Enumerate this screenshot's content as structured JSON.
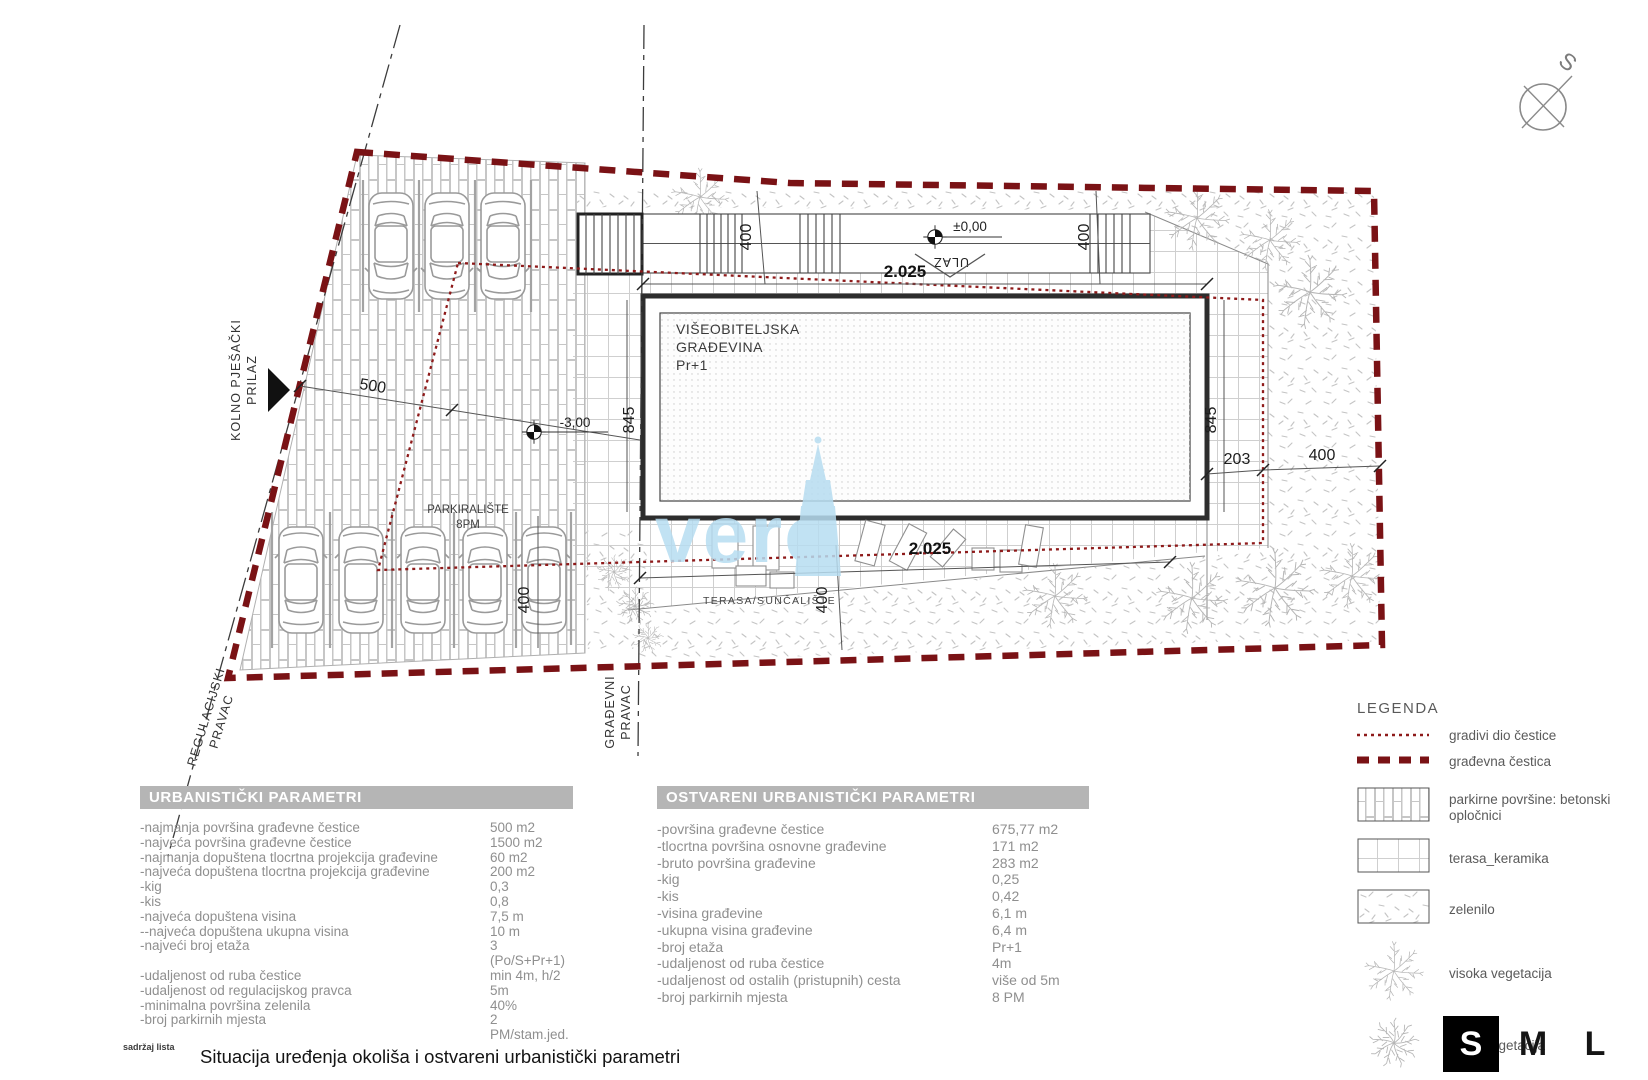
{
  "compass": {
    "north_label": "S"
  },
  "watermark": {
    "text": "vero"
  },
  "plan": {
    "labels": {
      "access_road_line1": "KOLNO PJEŠAČKI",
      "access_road_line2": "PRILAZ",
      "regulation_line1": "REGULACIJSKI",
      "regulation_line2": "PRAVAC",
      "building_line_line1": "GRAĐEVNI",
      "building_line_line2": "PRAVAC",
      "building_name_line1": "VIŠEOBITELJSKA",
      "building_name_line2": "GRAĐEVINA",
      "building_name_line3": "Pr+1",
      "parking_line1": "PARKIRALIŠTE",
      "parking_line2": "8PM",
      "terrace": "TERASA/SUNČALIŠTE",
      "entrance": "ULAZ",
      "entry_level": "±0,00",
      "parking_level": "-3,00"
    },
    "dims": {
      "building_width_top": "2.025",
      "building_width_bottom": "2.025",
      "building_depth_left": "845",
      "building_depth_right": "845",
      "front_setback_left": "400",
      "front_setback_right": "400",
      "parking_depth": "400",
      "rear_setback": "400",
      "side_gap": "203",
      "side_setback": "400",
      "access_width": "500"
    }
  },
  "legend": {
    "title": "LEGENDA",
    "items": [
      {
        "label": "gradivi dio čestice",
        "swatch": "thin-dashed-line"
      },
      {
        "label": "građevna čestica",
        "swatch": "thick-dashed-line"
      },
      {
        "label": "parkirne površine: betonski opločnici",
        "swatch": "brick"
      },
      {
        "label": "terasa_keramika",
        "swatch": "grid"
      },
      {
        "label": "zelenilo",
        "swatch": "speckle"
      },
      {
        "label": "visoka vegetacija",
        "swatch": "tree"
      },
      {
        "label": "niska vegetacija",
        "swatch": "bush"
      }
    ]
  },
  "tables": {
    "left": {
      "header": "URBANISTIČKI PARAMETRI",
      "rows": [
        {
          "label": "-najmanja površina građevne čestice",
          "value": "500 m2"
        },
        {
          "label": "-najveća površina građevne čestice",
          "value": "1500 m2"
        },
        {
          "label": "-najmanja dopuštena tlocrtna projekcija građevine",
          "value": "60 m2"
        },
        {
          "label": "-najveća dopuštena tlocrtna projekcija građevine",
          "value": "200 m2"
        },
        {
          "label": "-kig",
          "value": "0,3"
        },
        {
          "label": "-kis",
          "value": "0,8"
        },
        {
          "label": "-najveća dopuštena visina",
          "value": "7,5 m"
        },
        {
          "label": "--najveća dopuštena ukupna visina",
          "value": "10 m"
        },
        {
          "label": "-najveći broj etaža",
          "value": "3 (Po/S+Pr+1)"
        },
        {
          "label": "-udaljenost od ruba čestice",
          "value": "min 4m, h/2"
        },
        {
          "label": "-udaljenost od regulacijskog pravca",
          "value": "5m"
        },
        {
          "label": "-minimalna površina zelenila",
          "value": "40%"
        },
        {
          "label": "-broj parkirnih mjesta",
          "value": "2 PM/stam.jed."
        }
      ]
    },
    "right": {
      "header": "OSTVARENI URBANISTIČKI PARAMETRI",
      "rows": [
        {
          "label": "-površina građevne čestice",
          "value": "675,77 m2"
        },
        {
          "label": "-tlocrtna površina osnovne građevine",
          "value": "171 m2"
        },
        {
          "label": "-bruto površina građevine",
          "value": "283 m2"
        },
        {
          "label": "-kig",
          "value": "0,25"
        },
        {
          "label": "-kis",
          "value": "0,42"
        },
        {
          "label": "-visina građevine",
          "value": "6,1 m"
        },
        {
          "label": "-ukupna visina građevine",
          "value": "6,4 m"
        },
        {
          "label": "-broj etaža",
          "value": "Pr+1"
        },
        {
          "label": "-udaljenost od ruba čestice",
          "value": "4m"
        },
        {
          "label": "-udaljenost od ostalih (pristupnih) cesta",
          "value": "više od 5m"
        },
        {
          "label": "-broj parkirnih mjesta",
          "value": "8 PM"
        }
      ]
    }
  },
  "size_buttons": {
    "options": [
      "S",
      "M",
      "L"
    ],
    "selected": "S"
  },
  "footer": {
    "sheet_label": "sadržaj lista",
    "title": "Situacija uređenja okoliša i ostvareni urbanistički parametri"
  },
  "colors": {
    "boundary_red": "#7a1215",
    "buildable_red": "#8e1a1a",
    "watermark_blue": "#b7ddf1",
    "header_gray": "#b5b5b5"
  }
}
